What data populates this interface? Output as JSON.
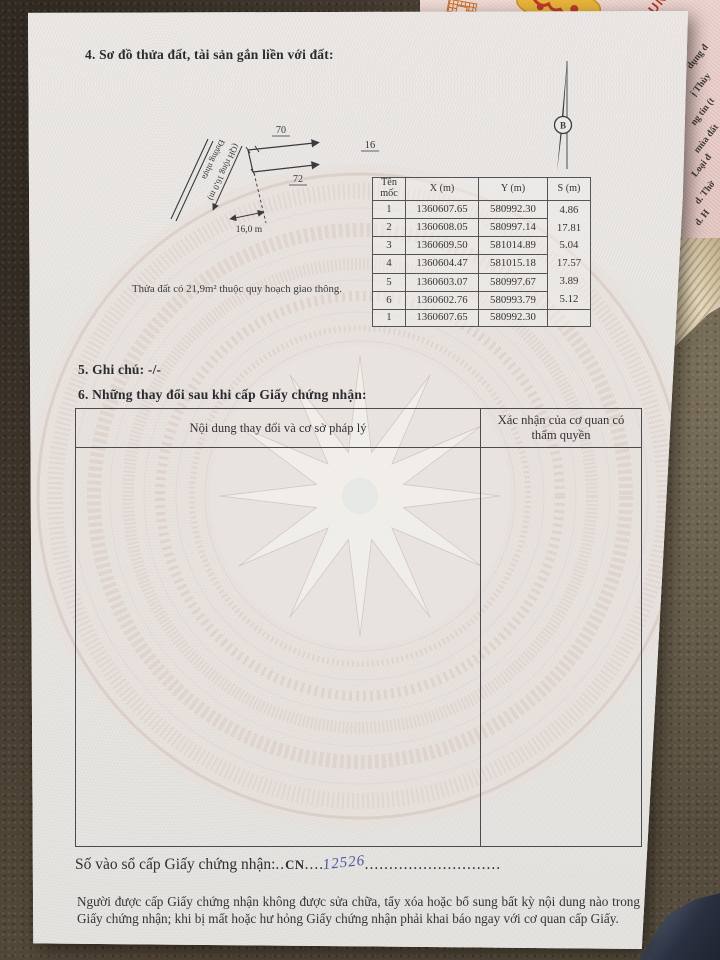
{
  "document": {
    "section4_title": "4. Sơ đồ thửa đất, tài sản gắn liền với đất:",
    "compass": {
      "north_label": "B"
    },
    "diagram": {
      "lot_top": "70",
      "lot_bottom": "72",
      "lot_right": "16",
      "road_name": "Đường nhựa",
      "road_plan": "(QH rộng 16,0 m)",
      "road_width": "16,0 m",
      "note": "Thửa đất có 21,9m² thuộc quy hoạch giao thông."
    },
    "coord_table": {
      "headers": {
        "moc": "Tên mốc",
        "x": "X (m)",
        "y": "Y (m)",
        "s": "S (m)"
      },
      "rows": [
        {
          "moc": "1",
          "x": "1360607.65",
          "y": "580992.30"
        },
        {
          "moc": "2",
          "x": "1360608.05",
          "y": "580997.14"
        },
        {
          "moc": "3",
          "x": "1360609.50",
          "y": "581014.89"
        },
        {
          "moc": "4",
          "x": "1360604.47",
          "y": "581015.18"
        },
        {
          "moc": "5",
          "x": "1360603.07",
          "y": "580997.67"
        },
        {
          "moc": "6",
          "x": "1360602.76",
          "y": "580993.79"
        },
        {
          "moc": "1",
          "x": "1360607.65",
          "y": "580992.30"
        }
      ],
      "s_values": [
        "4.86",
        "17.81",
        "5.04",
        "17.57",
        "3.89",
        "5.12"
      ]
    },
    "section5_title": "5. Ghi chú: -/-",
    "section6_title": "6. Những thay đổi sau khi cấp Giấy chứng nhận:",
    "changes_table": {
      "col1_header": "Nội dung thay đổi và cơ sở pháp lý",
      "col2_header": "Xác nhận của cơ quan có thẩm quyền"
    },
    "registry_line": {
      "label": "Số vào sổ cấp Giấy chứng nhận:",
      "dots_a": "..",
      "code": "CN",
      "dots_b": "....",
      "number": "12526",
      "dots_c": "............................"
    },
    "footer_note": "Người được cấp Giấy chứng nhận không được sửa chữa, tẩy xóa hoặc bổ sung bất kỳ nội dung nào trong Giấy chứng nhận; khi bị mất hoặc hư hỏng Giấy chứng nhận phải khai báo ngay với cơ quan cấp Giấy."
  },
  "background": {
    "corner_red_text": "DUN",
    "underlying_page_fragments": [
      "dụng đ",
      "ị Thùy",
      "ng tin (t",
      "mùa đất",
      "Loại đ",
      "d. Thờ",
      "d. H",
      "e."
    ]
  },
  "colors": {
    "page": "#eae8e5",
    "leather": "#453b30",
    "underlying_page": "#e5c9c4",
    "handwriting_blue": "#4d55a4",
    "watermark_rose": "#d8c3bd"
  }
}
